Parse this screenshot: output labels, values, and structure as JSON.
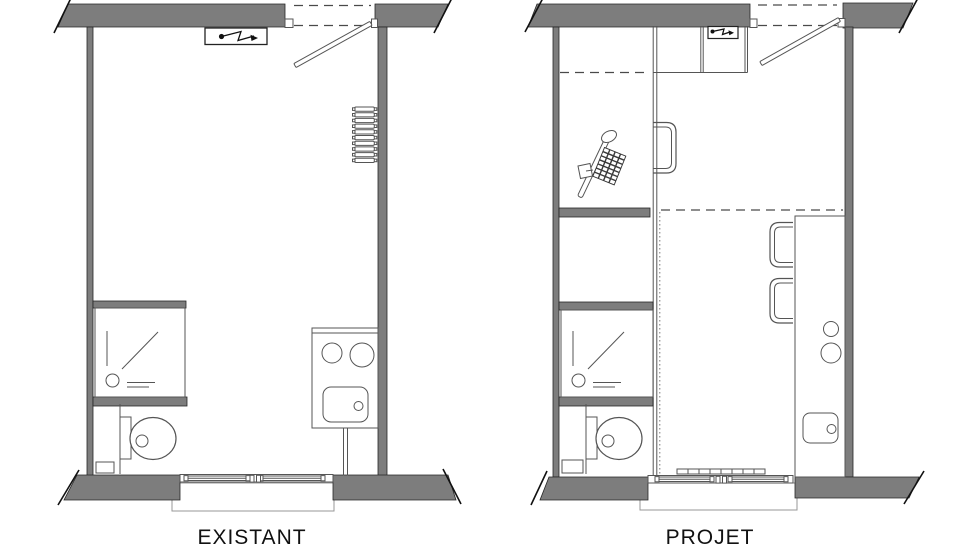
{
  "page": {
    "background": "#ffffff"
  },
  "colors": {
    "wall_fill": "#7d7d7d",
    "wall_edge": "#262626",
    "line": "#555555",
    "dash": "#4a4a4a",
    "text": "#111111"
  },
  "plans": {
    "existing": {
      "label": "EXISTANT",
      "fixtures": [
        "entry-door",
        "electrical-point",
        "radiator",
        "shower",
        "toilet",
        "kitchenette-burners-sink",
        "window",
        "duct"
      ]
    },
    "project": {
      "label": "PROJET",
      "fixtures": [
        "entry-door",
        "electrical-point",
        "wardrobe",
        "overhead-cupboard",
        "desk-monitor-keyboard-mouse",
        "desk-chair",
        "sliding-partition",
        "shower",
        "toilet",
        "bar-counter-burners-sink",
        "bar-chairs",
        "window-heater",
        "window",
        "duct"
      ]
    }
  }
}
